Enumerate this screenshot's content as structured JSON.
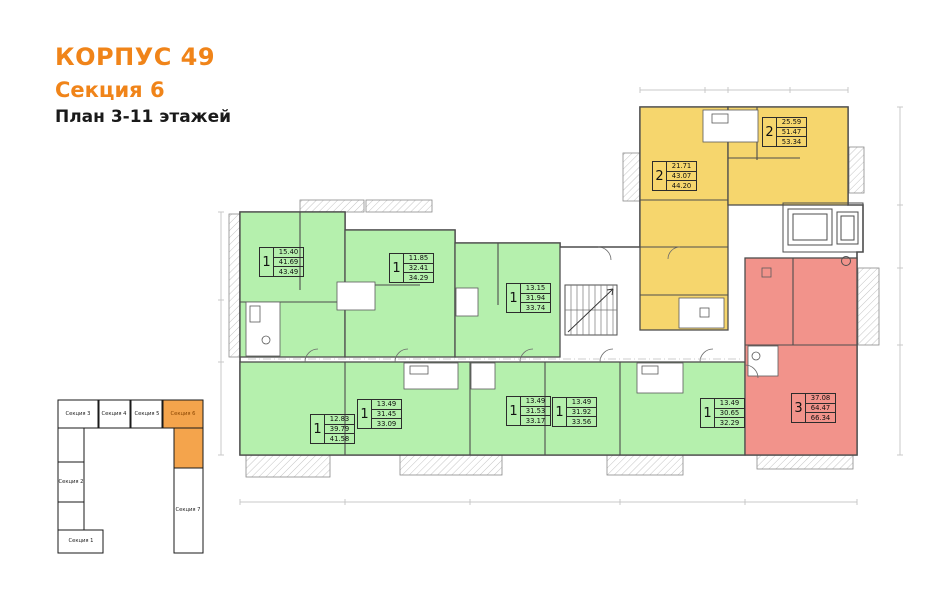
{
  "title": {
    "building": "КОРПУС 49",
    "section": "Секция 6",
    "plan": "План 3-11 этажей"
  },
  "colors": {
    "accent": "#f08419",
    "green": "#b5f0ad",
    "yellow": "#f6d66d",
    "red": "#f2938b",
    "minimap_orange": "#f4a44c",
    "minimap_highlight_text": "#8a4500",
    "wall": "#4d4d4d"
  },
  "apartments": [
    {
      "rooms": "1",
      "living": "15.40",
      "area": "41.69",
      "total": "43.49"
    },
    {
      "rooms": "1",
      "living": "11.85",
      "area": "32.41",
      "total": "34.29"
    },
    {
      "rooms": "1",
      "living": "13.15",
      "area": "31.94",
      "total": "33.74"
    },
    {
      "rooms": "2",
      "living": "21.71",
      "area": "43.07",
      "total": "44.20"
    },
    {
      "rooms": "2",
      "living": "25.59",
      "area": "51.47",
      "total": "53.34"
    },
    {
      "rooms": "1",
      "living": "12.83",
      "area": "39.79",
      "total": "41.58"
    },
    {
      "rooms": "1",
      "living": "13.49",
      "area": "31.45",
      "total": "33.09"
    },
    {
      "rooms": "1",
      "living": "13.49",
      "area": "31.53",
      "total": "33.17"
    },
    {
      "rooms": "1",
      "living": "13.49",
      "area": "31.92",
      "total": "33.56"
    },
    {
      "rooms": "1",
      "living": "13.49",
      "area": "30.65",
      "total": "32.29"
    },
    {
      "rooms": "3",
      "living": "37.08",
      "area": "64.47",
      "total": "66.34"
    }
  ],
  "minimap": {
    "highlighted": "Секция 6",
    "sections": [
      {
        "label": "Секция 3"
      },
      {
        "label": "Секция 4"
      },
      {
        "label": "Секция 5"
      },
      {
        "label": "Секция 6"
      },
      {
        "label": "Секция 2"
      },
      {
        "label": "Секция 1"
      },
      {
        "label": "Секция 7"
      }
    ]
  }
}
